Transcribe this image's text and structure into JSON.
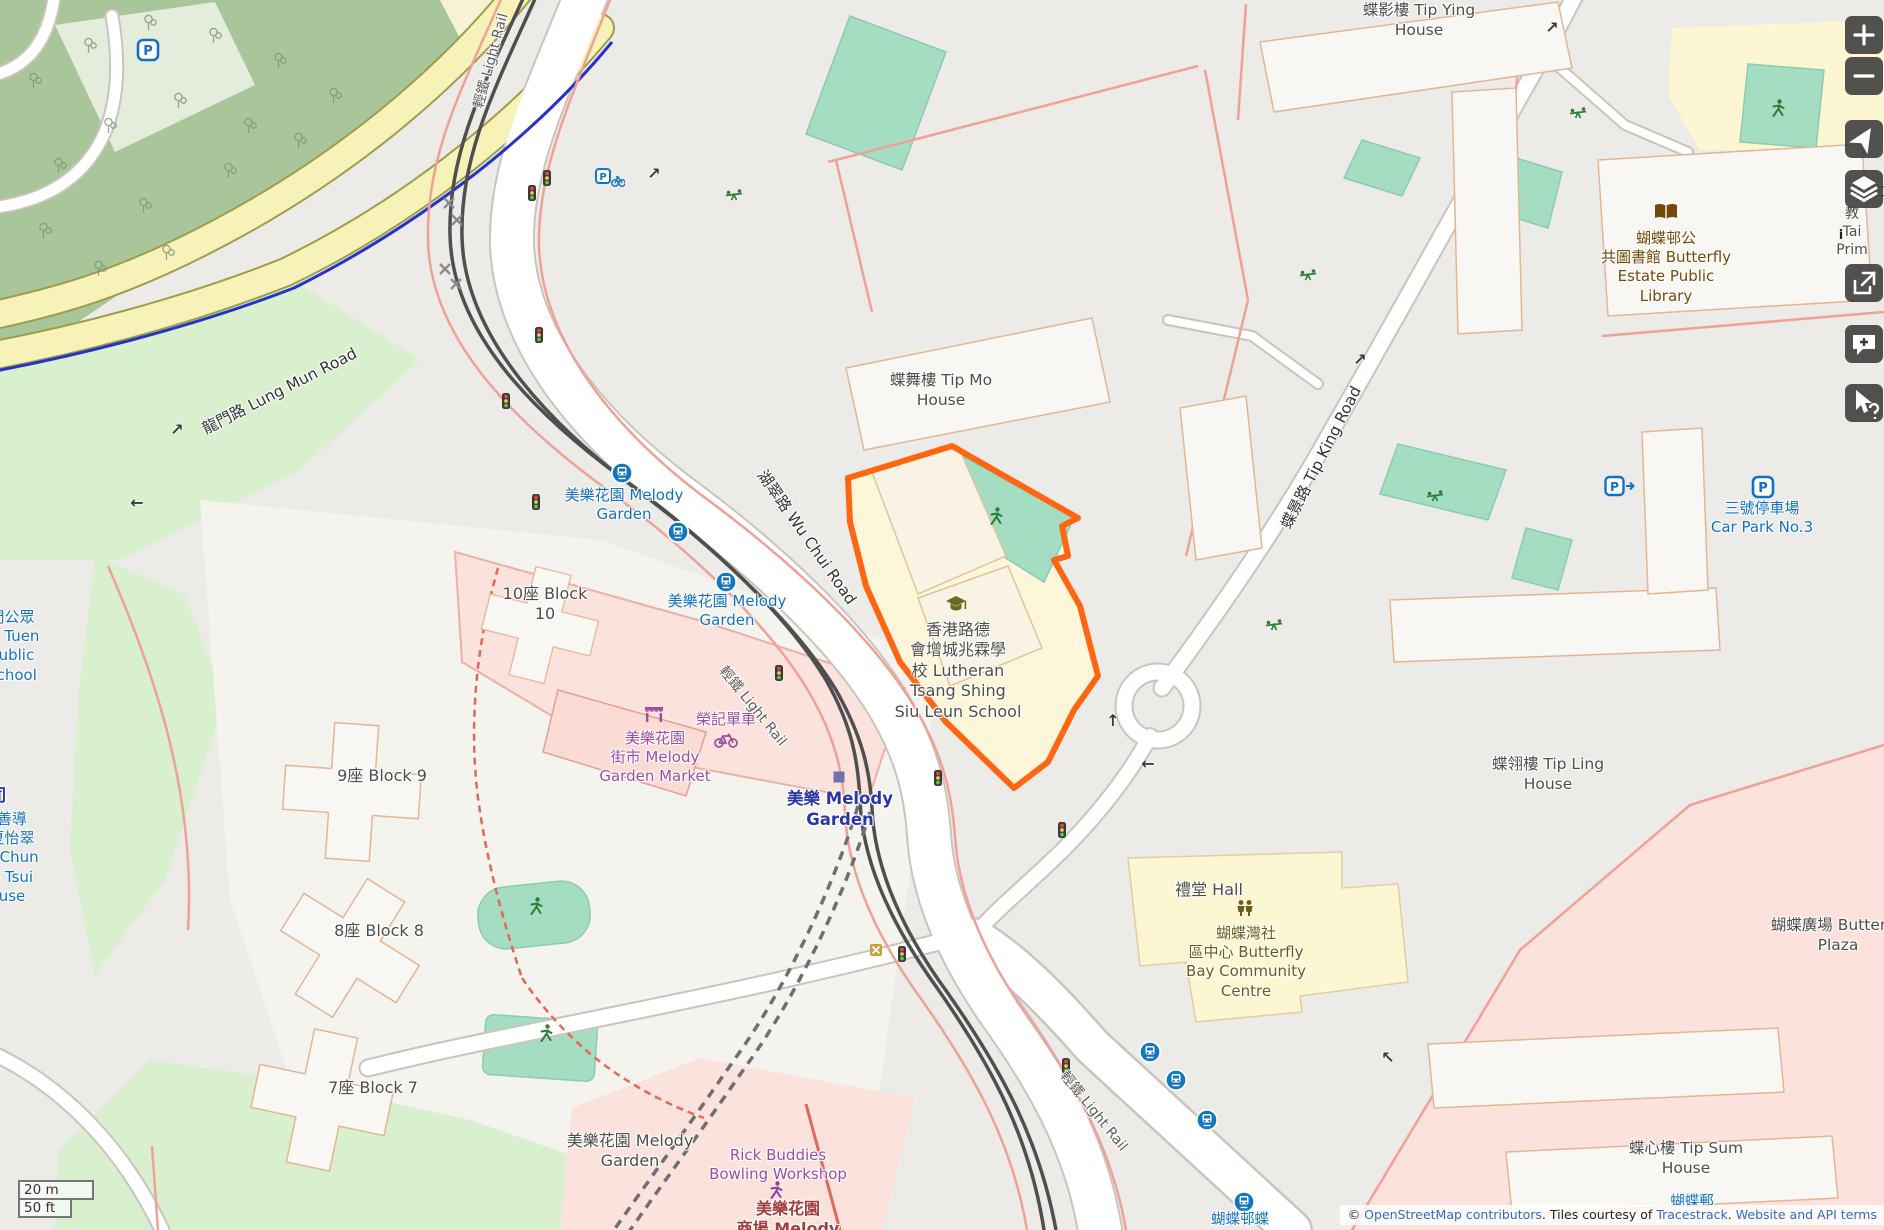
{
  "palette": {
    "highlight_orange": "#ff6613",
    "transit_blue": "#1272bf",
    "station_navy": "#2a36a5",
    "poi_purple": "#a04ba0",
    "poi_brown": "#734a08",
    "parking_blue": "#1271c6",
    "retail_red": "#a33e3e",
    "road_label": "#333333",
    "building_label": "#4d4d4b"
  },
  "scale": {
    "metric": "20 m",
    "imperial": "50 ft"
  },
  "attribution": {
    "prefix": "© ",
    "osm_link": "OpenStreetMap contributors",
    "middle": ". Tiles courtesy of ",
    "tracestrack_link": "Tracestrack",
    "sep": ". ",
    "terms_link": "Website and API terms"
  },
  "controls": [
    {
      "name": "zoom-in-button"
    },
    {
      "name": "zoom-out-button"
    },
    {
      "name": "locate-button"
    },
    {
      "name": "layers-button"
    },
    {
      "name": "share-button"
    },
    {
      "name": "add-note-button"
    },
    {
      "name": "query-features-button"
    }
  ],
  "map": {
    "labels": [
      {
        "name": "lbl-tip-ying-house",
        "lines": [
          "蝶影樓 Tip Ying",
          "House"
        ],
        "x": 1419,
        "y": 1,
        "color": "#4d4d4b",
        "size": 15.5
      },
      {
        "name": "lbl-library",
        "lines": [
          "蝴蝶邨公",
          "共圖書館 Butterfly",
          "Estate Public",
          "Library"
        ],
        "x": 1666,
        "y": 229,
        "color": "#734a08",
        "size": 15
      },
      {
        "name": "lbl-tip-mo-house",
        "lines": [
          "蝶舞樓 Tip Mo",
          "House"
        ],
        "x": 941,
        "y": 371,
        "color": "#4d4d4b",
        "size": 15.5
      },
      {
        "name": "lbl-melody-stop-north",
        "lines": [
          "美樂花園 Melody",
          "Garden"
        ],
        "x": 624,
        "y": 486,
        "color": "#1272bf",
        "size": 15
      },
      {
        "name": "lbl-melody-stop-south",
        "lines": [
          "美樂花園 Melody",
          "Garden"
        ],
        "x": 727,
        "y": 592,
        "color": "#1272bf",
        "size": 15
      },
      {
        "name": "lbl-block-10",
        "lines": [
          "10座 Block",
          "10"
        ],
        "x": 545,
        "y": 584,
        "color": "#4d4d4b",
        "size": 16
      },
      {
        "name": "lbl-block-9",
        "lines": [
          "9座 Block 9"
        ],
        "x": 382,
        "y": 766,
        "color": "#4d4d4b",
        "size": 16
      },
      {
        "name": "lbl-block-8",
        "lines": [
          "8座 Block 8"
        ],
        "x": 379,
        "y": 921,
        "color": "#4d4d4b",
        "size": 16
      },
      {
        "name": "lbl-block-7",
        "lines": [
          "7座 Block 7"
        ],
        "x": 373,
        "y": 1078,
        "color": "#4d4d4b",
        "size": 16
      },
      {
        "name": "lbl-market",
        "lines": [
          "美樂花園",
          "街市 Melody",
          "Garden Market"
        ],
        "x": 655,
        "y": 729,
        "color": "#a04ba0",
        "size": 15
      },
      {
        "name": "lbl-bike-shop",
        "lines": [
          "榮記單車"
        ],
        "x": 726,
        "y": 710,
        "color": "#a04ba0",
        "size": 15
      },
      {
        "name": "lbl-melody-station",
        "lines": [
          "美樂 Melody",
          "Garden"
        ],
        "x": 840,
        "y": 788,
        "color": "#2a36a5",
        "size": 16.5,
        "weight": 700
      },
      {
        "name": "lbl-school",
        "lines": [
          "香港路德",
          "會增城兆霖學",
          "校 Lutheran",
          "Tsang Shing",
          "Siu Leun School"
        ],
        "x": 958,
        "y": 620,
        "color": "#4f4f45",
        "size": 16
      },
      {
        "name": "lbl-hall",
        "lines": [
          "禮堂 Hall"
        ],
        "x": 1209,
        "y": 880,
        "color": "#4d4d4b",
        "size": 16
      },
      {
        "name": "lbl-community-centre",
        "lines": [
          "蝴蝶灣社",
          "區中心 Butterfly",
          "Bay Community",
          "Centre"
        ],
        "x": 1246,
        "y": 924,
        "color": "#6e5a1a",
        "size": 15
      },
      {
        "name": "lbl-tip-ling-house",
        "lines": [
          "蝶翎樓 Tip Ling",
          "House"
        ],
        "x": 1548,
        "y": 755,
        "color": "#4d4d4b",
        "size": 15.5
      },
      {
        "name": "lbl-butterfly-plaza",
        "lines": [
          "蝴蝶廣場 Butterfly",
          "Plaza"
        ],
        "x": 1838,
        "y": 916,
        "color": "#4d4d4b",
        "size": 15.5
      },
      {
        "name": "lbl-tip-sum-house",
        "lines": [
          "蝶心樓 Tip Sum",
          "House"
        ],
        "x": 1686,
        "y": 1139,
        "color": "#4d4d4b",
        "size": 15.5
      },
      {
        "name": "lbl-car-park-3",
        "lines": [
          "三號停車場",
          "Car Park No.3"
        ],
        "x": 1762,
        "y": 499,
        "color": "#1271c6",
        "size": 15
      },
      {
        "name": "lbl-bowling",
        "lines": [
          "Rick Buddies",
          "Bowling Workshop"
        ],
        "x": 778,
        "y": 1146,
        "color": "#a04ba0",
        "size": 15
      },
      {
        "name": "lbl-melody-garden-res",
        "lines": [
          "美樂花園 Melody",
          "Garden"
        ],
        "x": 630,
        "y": 1131,
        "color": "#4d4d4b",
        "size": 16
      },
      {
        "name": "lbl-melody-shopping",
        "lines": [
          "美樂花園",
          "商場 Melody"
        ],
        "x": 788,
        "y": 1199,
        "color": "#a33e3e",
        "size": 16,
        "weight": 700
      },
      {
        "name": "lbl-lung-mun-road",
        "lines": [
          "龍門路 Lung Mun Road"
        ],
        "x": 280,
        "y": 382,
        "color": "#333333",
        "size": 15.5,
        "rotate": -27
      },
      {
        "name": "lbl-wu-chui-road",
        "lines": [
          "湖翠路 Wu Chui Road"
        ],
        "x": 806,
        "y": 528,
        "color": "#333333",
        "size": 15.5,
        "rotate": 55
      },
      {
        "name": "lbl-tip-king-road",
        "lines": [
          "蝶景路 Tip King Road"
        ],
        "x": 1322,
        "y": 448,
        "color": "#333333",
        "size": 15.5,
        "rotate": -63
      },
      {
        "name": "lbl-light-rail-north",
        "lines": [
          "輕鐵 Light Rail"
        ],
        "x": 492,
        "y": 52,
        "color": "#5a5a58",
        "size": 14,
        "rotate": -75
      },
      {
        "name": "lbl-light-rail-mid",
        "lines": [
          "輕鐵 Light Rail"
        ],
        "x": 752,
        "y": 698,
        "color": "#5a5a58",
        "size": 14,
        "rotate": 51
      },
      {
        "name": "lbl-light-rail-south",
        "lines": [
          "輕鐵 Light Rail"
        ],
        "x": 1093,
        "y": 1103,
        "color": "#5a5a58",
        "size": 14,
        "rotate": 51
      },
      {
        "name": "lbl-cut-tuen-school",
        "lines": [
          "門公眾",
          "校 Tuen",
          "Public",
          "School"
        ],
        "x": 12,
        "y": 608,
        "color": "#1272bf",
        "size": 15
      },
      {
        "name": "lbl-cut-house",
        "lines": [
          "善導",
          "夏怡翠",
          "n Chun",
          "e Tsui",
          "use"
        ],
        "x": 12,
        "y": 810,
        "color": "#1272bf",
        "size": 15
      },
      {
        "name": "lbl-cut-station",
        "lines": [
          "司"
        ],
        "x": -2,
        "y": 786,
        "color": "#2a36a5",
        "size": 17,
        "weight": 700
      },
      {
        "name": "lbl-cut-post",
        "lines": [
          "蝴蝶郵"
        ],
        "x": 1692,
        "y": 1193,
        "color": "#1272bf",
        "size": 14.5
      },
      {
        "name": "lbl-cut-stop-south",
        "lines": [
          "蝴蝶邨蝶"
        ],
        "x": 1240,
        "y": 1211,
        "color": "#1272bf",
        "size": 14.5
      },
      {
        "name": "lbl-fragment-edge",
        "lines": [
          "教",
          "Tai",
          "Prim"
        ],
        "x": 1852,
        "y": 206,
        "color": "#4f4f45",
        "size": 14
      },
      {
        "name": "lbl-fragment-cjk",
        "lines": [
          "仁"
        ],
        "x": 1880,
        "y": 184,
        "color": "#4f4f45",
        "size": 14
      },
      {
        "name": "lbl-fragment-info",
        "lines": [
          "i"
        ],
        "x": 1841,
        "y": 228,
        "color": "#222222",
        "size": 13,
        "weight": 700
      }
    ],
    "icons": [
      {
        "type": "tram-stop",
        "x": 622,
        "y": 473
      },
      {
        "type": "tram-stop",
        "x": 678,
        "y": 532
      },
      {
        "type": "tram-stop",
        "x": 726,
        "y": 582
      },
      {
        "type": "bus-stop",
        "x": 1150,
        "y": 1052
      },
      {
        "type": "bus-stop",
        "x": 1176,
        "y": 1080
      },
      {
        "type": "bus-stop",
        "x": 1207,
        "y": 1120
      },
      {
        "type": "bus-stop",
        "x": 1244,
        "y": 1202
      },
      {
        "type": "parking",
        "x": 148,
        "y": 50
      },
      {
        "type": "parking",
        "x": 1763,
        "y": 487
      },
      {
        "type": "parking-access",
        "x": 1620,
        "y": 487
      },
      {
        "type": "bike-parking",
        "x": 610,
        "y": 178
      },
      {
        "type": "traffic-signal",
        "x": 547,
        "y": 178
      },
      {
        "type": "traffic-signal",
        "x": 532,
        "y": 193
      },
      {
        "type": "traffic-signal",
        "x": 539,
        "y": 335
      },
      {
        "type": "traffic-signal",
        "x": 506,
        "y": 401
      },
      {
        "type": "traffic-signal",
        "x": 536,
        "y": 502
      },
      {
        "type": "traffic-signal",
        "x": 779,
        "y": 673
      },
      {
        "type": "traffic-signal",
        "x": 938,
        "y": 778
      },
      {
        "type": "traffic-signal",
        "x": 1062,
        "y": 830
      },
      {
        "type": "traffic-signal",
        "x": 902,
        "y": 954
      },
      {
        "type": "traffic-signal",
        "x": 1066,
        "y": 1066
      },
      {
        "type": "playground",
        "x": 734,
        "y": 196
      },
      {
        "type": "playground",
        "x": 1308,
        "y": 276
      },
      {
        "type": "playground",
        "x": 1578,
        "y": 114
      },
      {
        "type": "playground",
        "x": 1274,
        "y": 626
      },
      {
        "type": "playground",
        "x": 1435,
        "y": 497
      },
      {
        "type": "person-green",
        "x": 996,
        "y": 516
      },
      {
        "type": "person-green",
        "x": 536,
        "y": 906
      },
      {
        "type": "person-green",
        "x": 546,
        "y": 1033
      },
      {
        "type": "person-green",
        "x": 1778,
        "y": 108
      },
      {
        "type": "person-purple",
        "x": 776,
        "y": 1190
      },
      {
        "type": "market",
        "x": 654,
        "y": 714
      },
      {
        "type": "bicycle",
        "x": 726,
        "y": 740
      },
      {
        "type": "school",
        "x": 956,
        "y": 604
      },
      {
        "type": "community",
        "x": 1245,
        "y": 908
      },
      {
        "type": "library",
        "x": 1666,
        "y": 212
      },
      {
        "type": "station-square",
        "x": 839,
        "y": 777
      },
      {
        "type": "level-crossing",
        "x": 876,
        "y": 950
      },
      {
        "type": "cross-mark",
        "x": 449,
        "y": 203
      },
      {
        "type": "cross-mark",
        "x": 457,
        "y": 220
      },
      {
        "type": "cross-mark",
        "x": 445,
        "y": 269
      },
      {
        "type": "cross-mark",
        "x": 456,
        "y": 284
      },
      {
        "type": "arrow",
        "glyph": "↗",
        "x": 177,
        "y": 430
      },
      {
        "type": "arrow",
        "glyph": "←",
        "x": 137,
        "y": 503
      },
      {
        "type": "arrow",
        "glyph": "↗",
        "x": 654,
        "y": 174
      },
      {
        "type": "arrow",
        "glyph": "↑",
        "x": 1113,
        "y": 721
      },
      {
        "type": "arrow",
        "glyph": "←",
        "x": 1148,
        "y": 764
      },
      {
        "type": "arrow",
        "glyph": "↗",
        "x": 1360,
        "y": 360
      },
      {
        "type": "arrow",
        "glyph": "↗",
        "x": 1552,
        "y": 28
      },
      {
        "type": "arrow",
        "glyph": "↖",
        "x": 1388,
        "y": 1058
      },
      {
        "type": "tree",
        "x": 35,
        "y": 80
      },
      {
        "type": "tree",
        "x": 90,
        "y": 45
      },
      {
        "type": "tree",
        "x": 150,
        "y": 22
      },
      {
        "type": "tree",
        "x": 215,
        "y": 35
      },
      {
        "type": "tree",
        "x": 280,
        "y": 60
      },
      {
        "type": "tree",
        "x": 335,
        "y": 95
      },
      {
        "type": "tree",
        "x": 250,
        "y": 125
      },
      {
        "type": "tree",
        "x": 180,
        "y": 100
      },
      {
        "type": "tree",
        "x": 110,
        "y": 125
      },
      {
        "type": "tree",
        "x": 60,
        "y": 165
      },
      {
        "type": "tree",
        "x": 145,
        "y": 205
      },
      {
        "type": "tree",
        "x": 230,
        "y": 170
      },
      {
        "type": "tree",
        "x": 300,
        "y": 140
      },
      {
        "type": "tree",
        "x": 45,
        "y": 230
      },
      {
        "type": "tree",
        "x": 100,
        "y": 268
      },
      {
        "type": "tree",
        "x": 168,
        "y": 252
      }
    ]
  }
}
